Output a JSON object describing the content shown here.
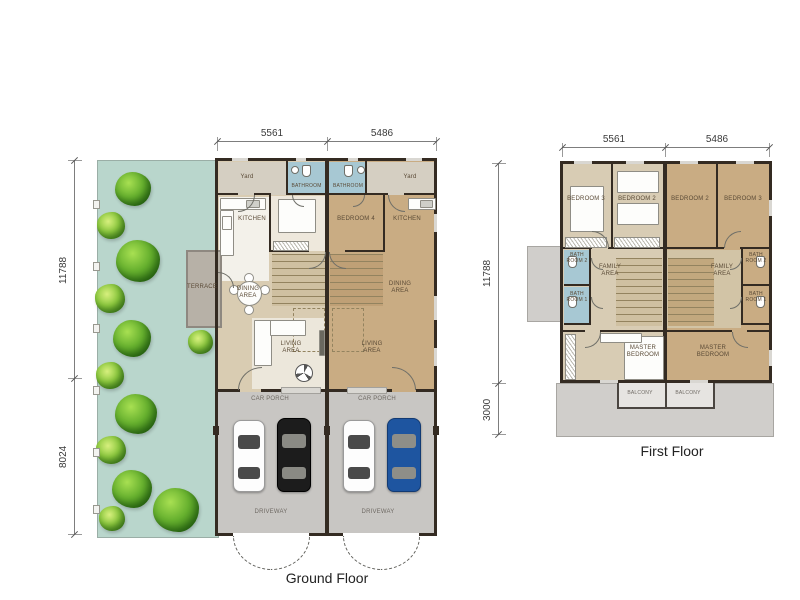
{
  "ground_floor": {
    "title": "Ground Floor",
    "dimensions": {
      "top_left": "5561",
      "top_right": "5486",
      "side_upper": "11788",
      "side_lower": "8024"
    },
    "labels": {
      "yard_left": "Yard",
      "yard_right": "Yard",
      "bathroom_left": "BATHROOM",
      "bathroom_right": "BATHROOM",
      "kitchen_left": "KITCHEN",
      "kitchen_right": "KITCHEN",
      "bedroom4": "BEDROOM 4",
      "terrace": "TERRACE",
      "dining_left": "DINING AREA",
      "dining_right": "DINING AREA",
      "living_left": "LIVING AREA",
      "living_right": "LIVING AREA",
      "car_porch_left": "CAR PORCH",
      "car_porch_right": "CAR PORCH",
      "driveway_left": "DRIVEWAY",
      "driveway_right": "DRIVEWAY"
    }
  },
  "first_floor": {
    "title": "First Floor",
    "dimensions": {
      "top_left": "5561",
      "top_right": "5486",
      "side_upper": "11788",
      "side_lower": "3000"
    },
    "labels": {
      "bedroom3_left": "BEDROOM 3",
      "bedroom2_left": "BEDROOM 2",
      "bedroom2_right": "BEDROOM 2",
      "bedroom3_right": "BEDROOM 3",
      "bathroom2_left": "BATH ROOM 2",
      "bathroom1_left": "BATH ROOM 1",
      "bathroom2_right": "BATH ROOM 2",
      "bathroom1_right": "BATH ROOM 1",
      "family_left": "FAMILY AREA",
      "family_right": "FAMILY AREA",
      "master_left": "MASTER BEDROOM",
      "master_right": "MASTER BEDROOM",
      "balcony_left": "BALCONY",
      "balcony_right": "BALCONY"
    }
  },
  "colors": {
    "wall": "#342b22",
    "garden_teal": "#b9d6cc",
    "floor_tan": "#c9ac83",
    "floor_beige": "#d9ccb2",
    "bathroom_blue": "#a7c8d3",
    "paving_grey": "#c8c6c3",
    "roof_grey": "#d0cecb",
    "car_white": "#ffffff",
    "car_black": "#1c1c1c",
    "car_blue": "#1e55a0",
    "tree_green": "#66b02e"
  }
}
